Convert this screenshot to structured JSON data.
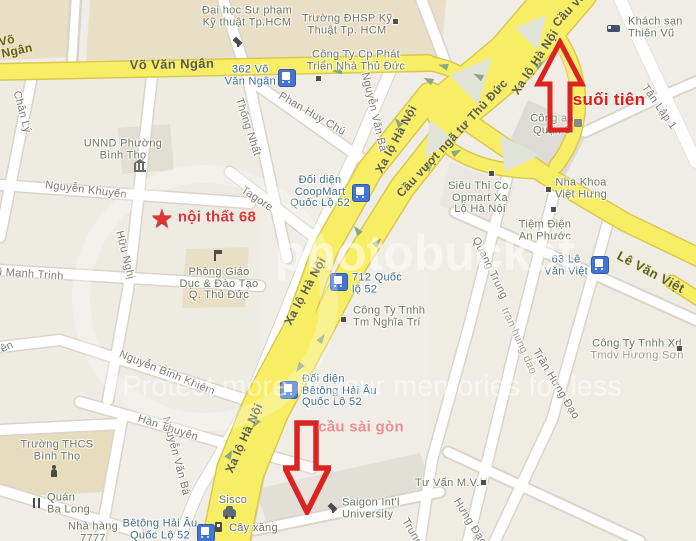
{
  "annotations": {
    "noi_that_68": "nội thất 68",
    "suoi_tien": "suối tiên",
    "cau_sai_gon": "cầu sài gòn"
  },
  "icons": {
    "star": "★"
  },
  "roads": {
    "vo_van_ngan": "Võ Văn Ngân",
    "vvn_partial_l1": "Võ",
    "vvn_partial_l2": "Ngân",
    "xa_lo_ha_noi": "Xa lộ Hà Nội",
    "cau_vuot_nga_tu": "Cầu vượt ngã tư Thủ Đức",
    "cau_vuot_partial": "Cầu vượt",
    "le_van_viet": "Lê Văn Việt"
  },
  "streets": {
    "chan_ly": "Chân Lý",
    "huu_nghi": "Hữu Nghị",
    "nguyen_khuyen": "Nguyễn Khuyến",
    "vu_manh_trinh": "Vũ Mạnh Trinh",
    "thong_nhat": "Thống Nhất",
    "phan_huy_chu": "Phan Huy Chú",
    "nguyen_van_ba": "Nguyễn Văn Bá",
    "tagore": "Tagore",
    "nguyen_binh_khiem": "Nguyễn Bỉnh Khiêm",
    "han_thuyen": "Hàn Thuyên",
    "quang_trung": "Quang Trung",
    "tran_hung_dao_lower": "tran hung dao",
    "tran_hung_dao": "Trần Hưng Đạo",
    "tan_lap_1": "Tân Lập 1",
    "partial_en": "ên",
    "quang_trung_tail": "Trung",
    "tran_hung_dao_tail": "Hưng Đạo"
  },
  "pois": {
    "dai_hoc": {
      "l1": "Đại học Sư phạm",
      "l2": "Kỹ thuật Tp.HCM"
    },
    "truong_dhsp": {
      "l1": "Trường ĐHSP Kỹ",
      "l2": "Thuật Tp. HCM"
    },
    "cong_ty_cp": {
      "l1": "Công Ty Cp Phát",
      "l2": "Triển Nhà Thủ Đức"
    },
    "khach_san": {
      "l1": "Khách sạn",
      "l2": "Thiên Vũ"
    },
    "cong_an": {
      "l1": "Công an",
      "l2": "Quận 9"
    },
    "unnd": {
      "l1": "UNND Phường",
      "l2": "Bình Thọ"
    },
    "phong_giao_duc": {
      "l1": "Phòng Giáo",
      "l2": "Dục & Đào Tạo",
      "l3": "Q. Thủ Đức"
    },
    "sieu_thi": {
      "l1": "Siêu Thị Co.",
      "l2": "Opmart Xa",
      "l3": "Lộ Hà Nội"
    },
    "nha_khoa": {
      "l1": "Nha Khoa",
      "l2": "Việt Hưng"
    },
    "tiem_dien": {
      "l1": "Tiệm Điện",
      "l2": "An Phước"
    },
    "nghia_tri": {
      "l1": "Công Ty Tnhh",
      "l2": "Tm Nghĩa Trí"
    },
    "huong_son": {
      "l1": "Công Ty Tnhh Xd",
      "l2": "Tmdv Hương Sơn"
    },
    "truong_thcs": {
      "l1": "Trường THCS",
      "l2": "Bình Thọ"
    },
    "quan_ba_long": {
      "l1": "Quán",
      "l2": "Ba Long"
    },
    "nha_hang": {
      "l1": "Nhà hàng",
      "l2": "7777"
    },
    "sisco": "Sisco",
    "cay_xang": "Cây xăng",
    "saigon_univ": {
      "l1": "Saigon Int'l",
      "l2": "University"
    },
    "tu_van": "Tư Vấn M.V.H"
  },
  "bus_stops": {
    "vvn_362": {
      "l1": "362 Võ",
      "l2": "Văn Ngân"
    },
    "coopmart": {
      "l1": "Đối diện",
      "l2": "CoopMart",
      "l3": "Quốc Lộ 52"
    },
    "ql_712": {
      "l1": "712 Quốc",
      "l2": "lộ 52"
    },
    "betong": {
      "l1": "Đối diện",
      "l2": "Bêtông Hải Âu",
      "l3": "Quốc Lộ 52"
    },
    "lvv_63": {
      "l1": "63 Lê",
      "l2": "Văn Việt"
    },
    "betong_2": {
      "l1": "Bêtông Hải Âu",
      "l2": "Quốc Lộ 52"
    }
  },
  "watermark": {
    "logo": "photobucket",
    "slogan": "Protect more of your memories for less"
  },
  "colors": {
    "highway": "#f8ee66",
    "highway_casing": "#dcc850",
    "street": "#ffffff",
    "annotation_red": "#dc2222",
    "annotation_pink": "#ee8d8f",
    "bus_blue": "#4276d2",
    "poi_text": "#6f7760",
    "street_text": "#7d7c75"
  }
}
